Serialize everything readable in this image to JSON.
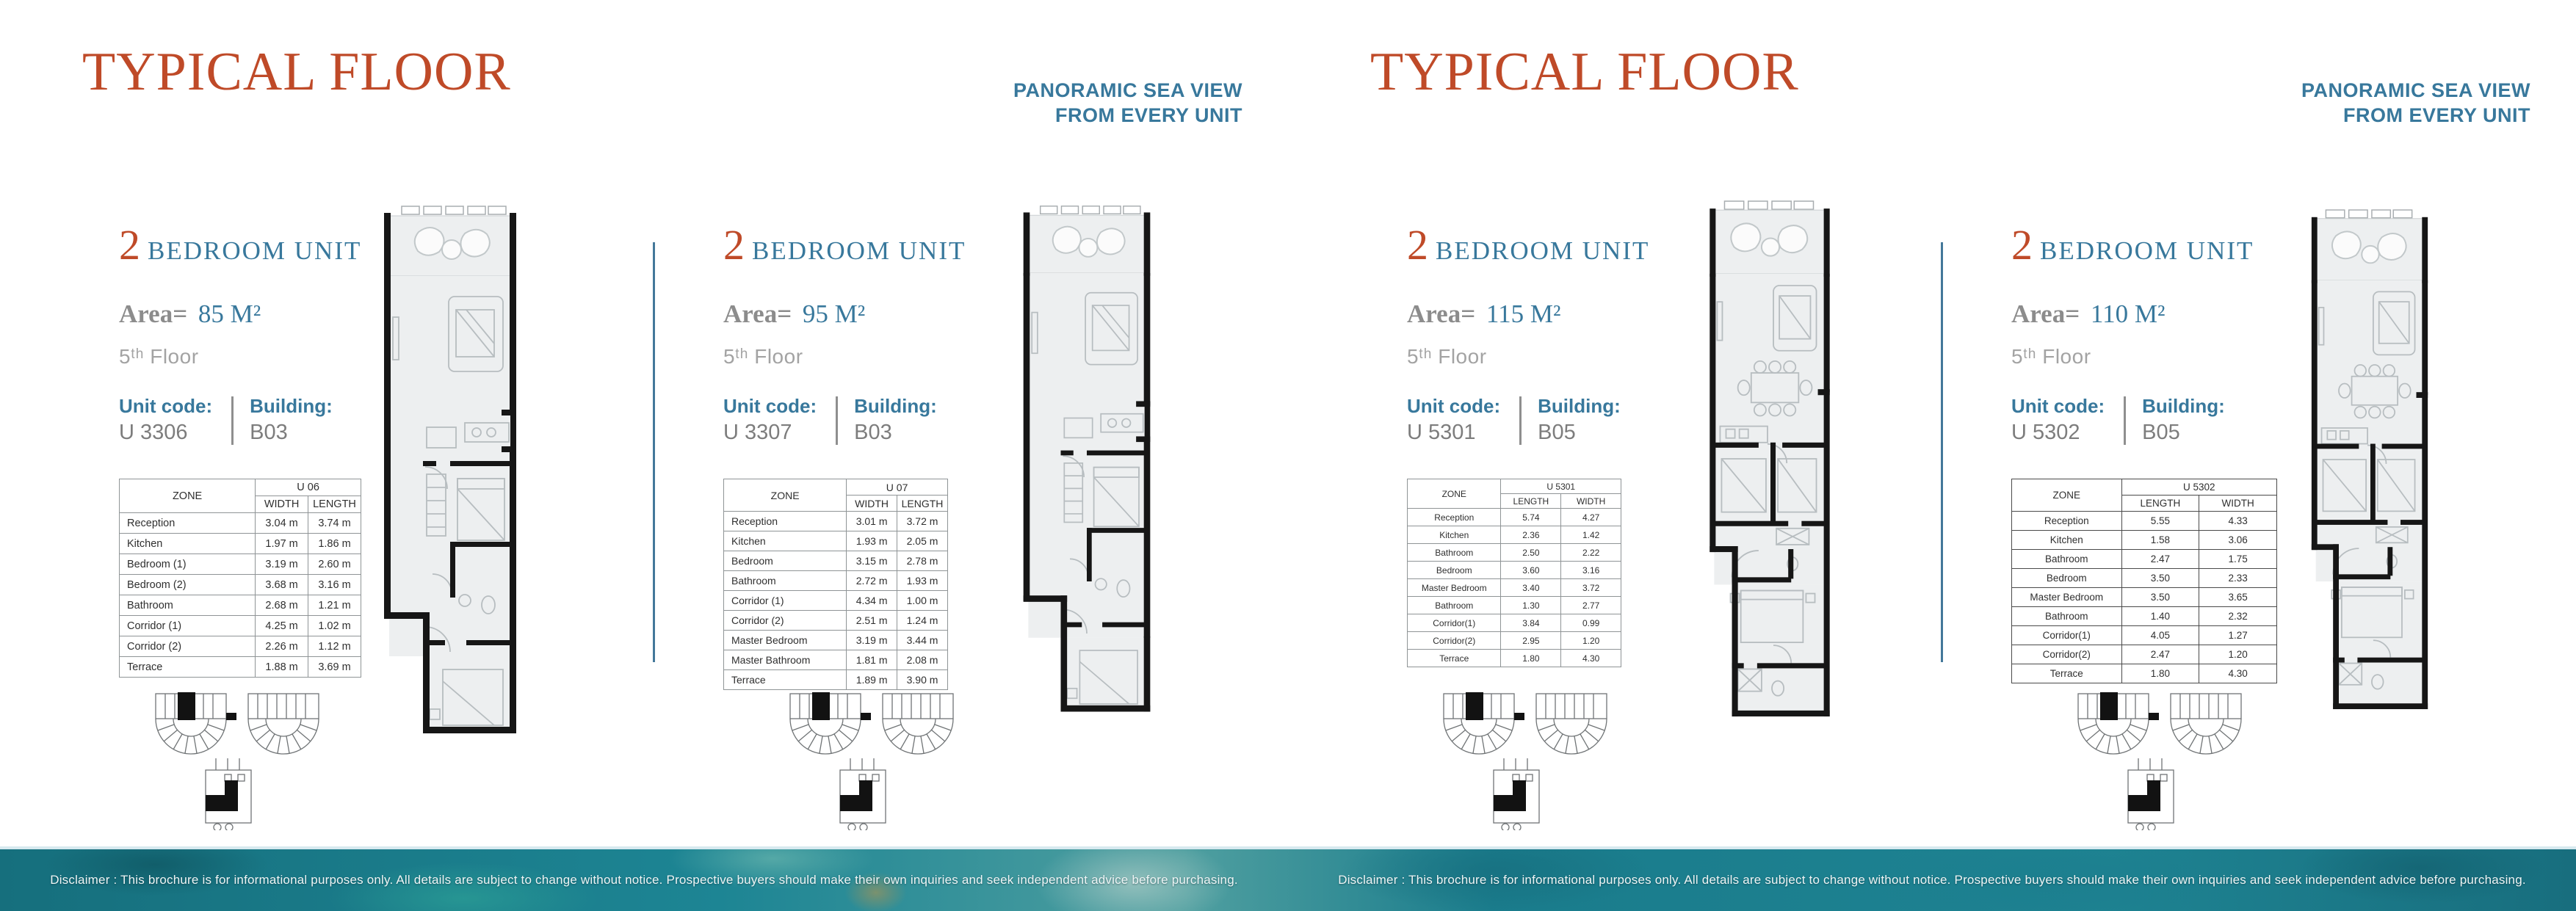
{
  "pages": [
    {
      "title": "TYPICAL FLOOR",
      "tagline_line1": "PANORAMIC SEA VIEW",
      "tagline_line2": "FROM EVERY UNIT"
    },
    {
      "title": "TYPICAL FLOOR",
      "tagline_line1": "PANORAMIC SEA VIEW",
      "tagline_line2": "FROM EVERY UNIT"
    }
  ],
  "colors": {
    "accent_orange": "#bf4a28",
    "accent_teal": "#38789c",
    "divider_teal": "#44789a",
    "text_gray": "#8c8c8c"
  },
  "panels": [
    {
      "unit_number": "2",
      "unit_type": "BEDROOM UNIT",
      "area_label": "Area=",
      "area_value": "85 M²",
      "floor": "5ᵗʰ Floor",
      "unit_code_label": "Unit code:",
      "unit_code": "U 3306",
      "building_label": "Building:",
      "building": "B03",
      "table": {
        "zone_header": "ZONE",
        "unit_header": "U 06",
        "col1": "WIDTH",
        "col2": "LENGTH",
        "rows": [
          [
            "Reception",
            "3.04 m",
            "3.74 m"
          ],
          [
            "Kitchen",
            "1.97 m",
            "1.86 m"
          ],
          [
            "Bedroom (1)",
            "3.19 m",
            "2.60 m"
          ],
          [
            "Bedroom (2)",
            "3.68 m",
            "3.16 m"
          ],
          [
            "Bathroom",
            "2.68 m",
            "1.21 m"
          ],
          [
            "Corridor (1)",
            "4.25 m",
            "1.02 m"
          ],
          [
            "Corridor (2)",
            "2.26 m",
            "1.12 m"
          ],
          [
            "Terrace",
            "1.88 m",
            "3.69 m"
          ]
        ]
      }
    },
    {
      "unit_number": "2",
      "unit_type": "BEDROOM UNIT",
      "area_label": "Area=",
      "area_value": "95 M²",
      "floor": "5ᵗʰ Floor",
      "unit_code_label": "Unit code:",
      "unit_code": "U 3307",
      "building_label": "Building:",
      "building": "B03",
      "table": {
        "zone_header": "ZONE",
        "unit_header": "U 07",
        "col1": "WIDTH",
        "col2": "LENGTH",
        "rows": [
          [
            "Reception",
            "3.01 m",
            "3.72 m"
          ],
          [
            "Kitchen",
            "1.93 m",
            "2.05 m"
          ],
          [
            "Bedroom",
            "3.15 m",
            "2.78 m"
          ],
          [
            "Bathroom",
            "2.72 m",
            "1.93 m"
          ],
          [
            "Corridor (1)",
            "4.34 m",
            "1.00 m"
          ],
          [
            "Corridor (2)",
            "2.51 m",
            "1.24 m"
          ],
          [
            "Master Bedroom",
            "3.19 m",
            "3.44 m"
          ],
          [
            "Master Bathroom",
            "1.81 m",
            "2.08 m"
          ],
          [
            "Terrace",
            "1.89 m",
            "3.90 m"
          ]
        ]
      }
    },
    {
      "unit_number": "2",
      "unit_type": "BEDROOM UNIT",
      "area_label": "Area=",
      "area_value": "115 M²",
      "floor": "5ᵗʰ Floor",
      "unit_code_label": "Unit code:",
      "unit_code": "U 5301",
      "building_label": "Building:",
      "building": "B05",
      "table": {
        "zone_header": "ZONE",
        "unit_header": "U 5301",
        "col1": "LENGTH",
        "col2": "WIDTH",
        "rows": [
          [
            "Reception",
            "5.74",
            "4.27"
          ],
          [
            "Kitchen",
            "2.36",
            "1.42"
          ],
          [
            "Bathroom",
            "2.50",
            "2.22"
          ],
          [
            "Bedroom",
            "3.60",
            "3.16"
          ],
          [
            "Master Bedroom",
            "3.40",
            "3.72"
          ],
          [
            "Bathroom",
            "1.30",
            "2.77"
          ],
          [
            "Corridor(1)",
            "3.84",
            "0.99"
          ],
          [
            "Corridor(2)",
            "2.95",
            "1.20"
          ],
          [
            "Terrace",
            "1.80",
            "4.30"
          ]
        ]
      }
    },
    {
      "unit_number": "2",
      "unit_type": "BEDROOM UNIT",
      "area_label": "Area=",
      "area_value": "110 M²",
      "floor": "5ᵗʰ Floor",
      "unit_code_label": "Unit code:",
      "unit_code": "U 5302",
      "building_label": "Building:",
      "building": "B05",
      "table": {
        "zone_header": "ZONE",
        "unit_header": "U 5302",
        "col1": "LENGTH",
        "col2": "WIDTH",
        "rows": [
          [
            "Reception",
            "5.55",
            "4.33"
          ],
          [
            "Kitchen",
            "1.58",
            "3.06"
          ],
          [
            "Bathroom",
            "2.47",
            "1.75"
          ],
          [
            "Bedroom",
            "3.50",
            "2.33"
          ],
          [
            "Master Bedroom",
            "3.50",
            "3.65"
          ],
          [
            "Bathroom",
            "1.40",
            "2.32"
          ],
          [
            "Corridor(1)",
            "4.05",
            "1.27"
          ],
          [
            "Corridor(2)",
            "2.47",
            "1.20"
          ],
          [
            "Terrace",
            "1.80",
            "4.30"
          ]
        ]
      }
    }
  ],
  "disclaimer": "Disclaimer : This brochure is for informational purposes only. All details are subject to change without notice. Prospective buyers should make their own inquiries and seek independent advice before purchasing."
}
